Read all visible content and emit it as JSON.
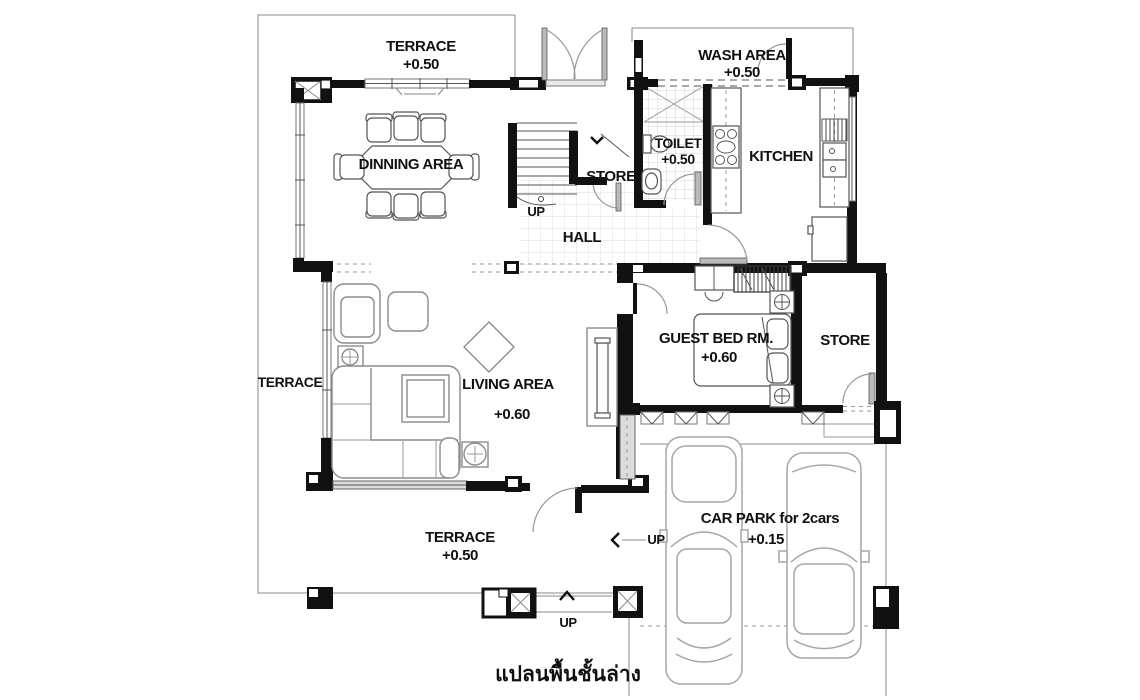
{
  "caption": "แปลนพื้นชั้นล่าง",
  "colors": {
    "wall": "#111111",
    "line": "#666666",
    "light": "#aaaaaa",
    "furn": "#8c8c8c",
    "bg": "#ffffff"
  },
  "labels": {
    "terrace_top": {
      "name": "TERRACE",
      "level": "+0.50"
    },
    "wash_area": {
      "name": "WASH AREA",
      "level": "+0.50"
    },
    "dining": {
      "name": "DINNING AREA"
    },
    "toilet": {
      "name": "TOILET",
      "level": "+0.50"
    },
    "kitchen": {
      "name": "KITCHEN"
    },
    "store_mid": {
      "name": "STORE"
    },
    "hall": {
      "name": "HALL"
    },
    "guest_bedroom": {
      "name": "GUEST BED RM.",
      "level": "+0.60"
    },
    "store_right": {
      "name": "STORE"
    },
    "terrace_left": {
      "name": "TERRACE"
    },
    "living": {
      "name": "LIVING AREA",
      "level": "+0.60"
    },
    "terrace_bottom": {
      "name": "TERRACE",
      "level": "+0.50"
    },
    "car_park": {
      "name": "CAR PARK for 2cars",
      "level": "+0.15"
    },
    "up_stairs": "UP",
    "up_carpark": "UP",
    "up_entry": "UP"
  }
}
